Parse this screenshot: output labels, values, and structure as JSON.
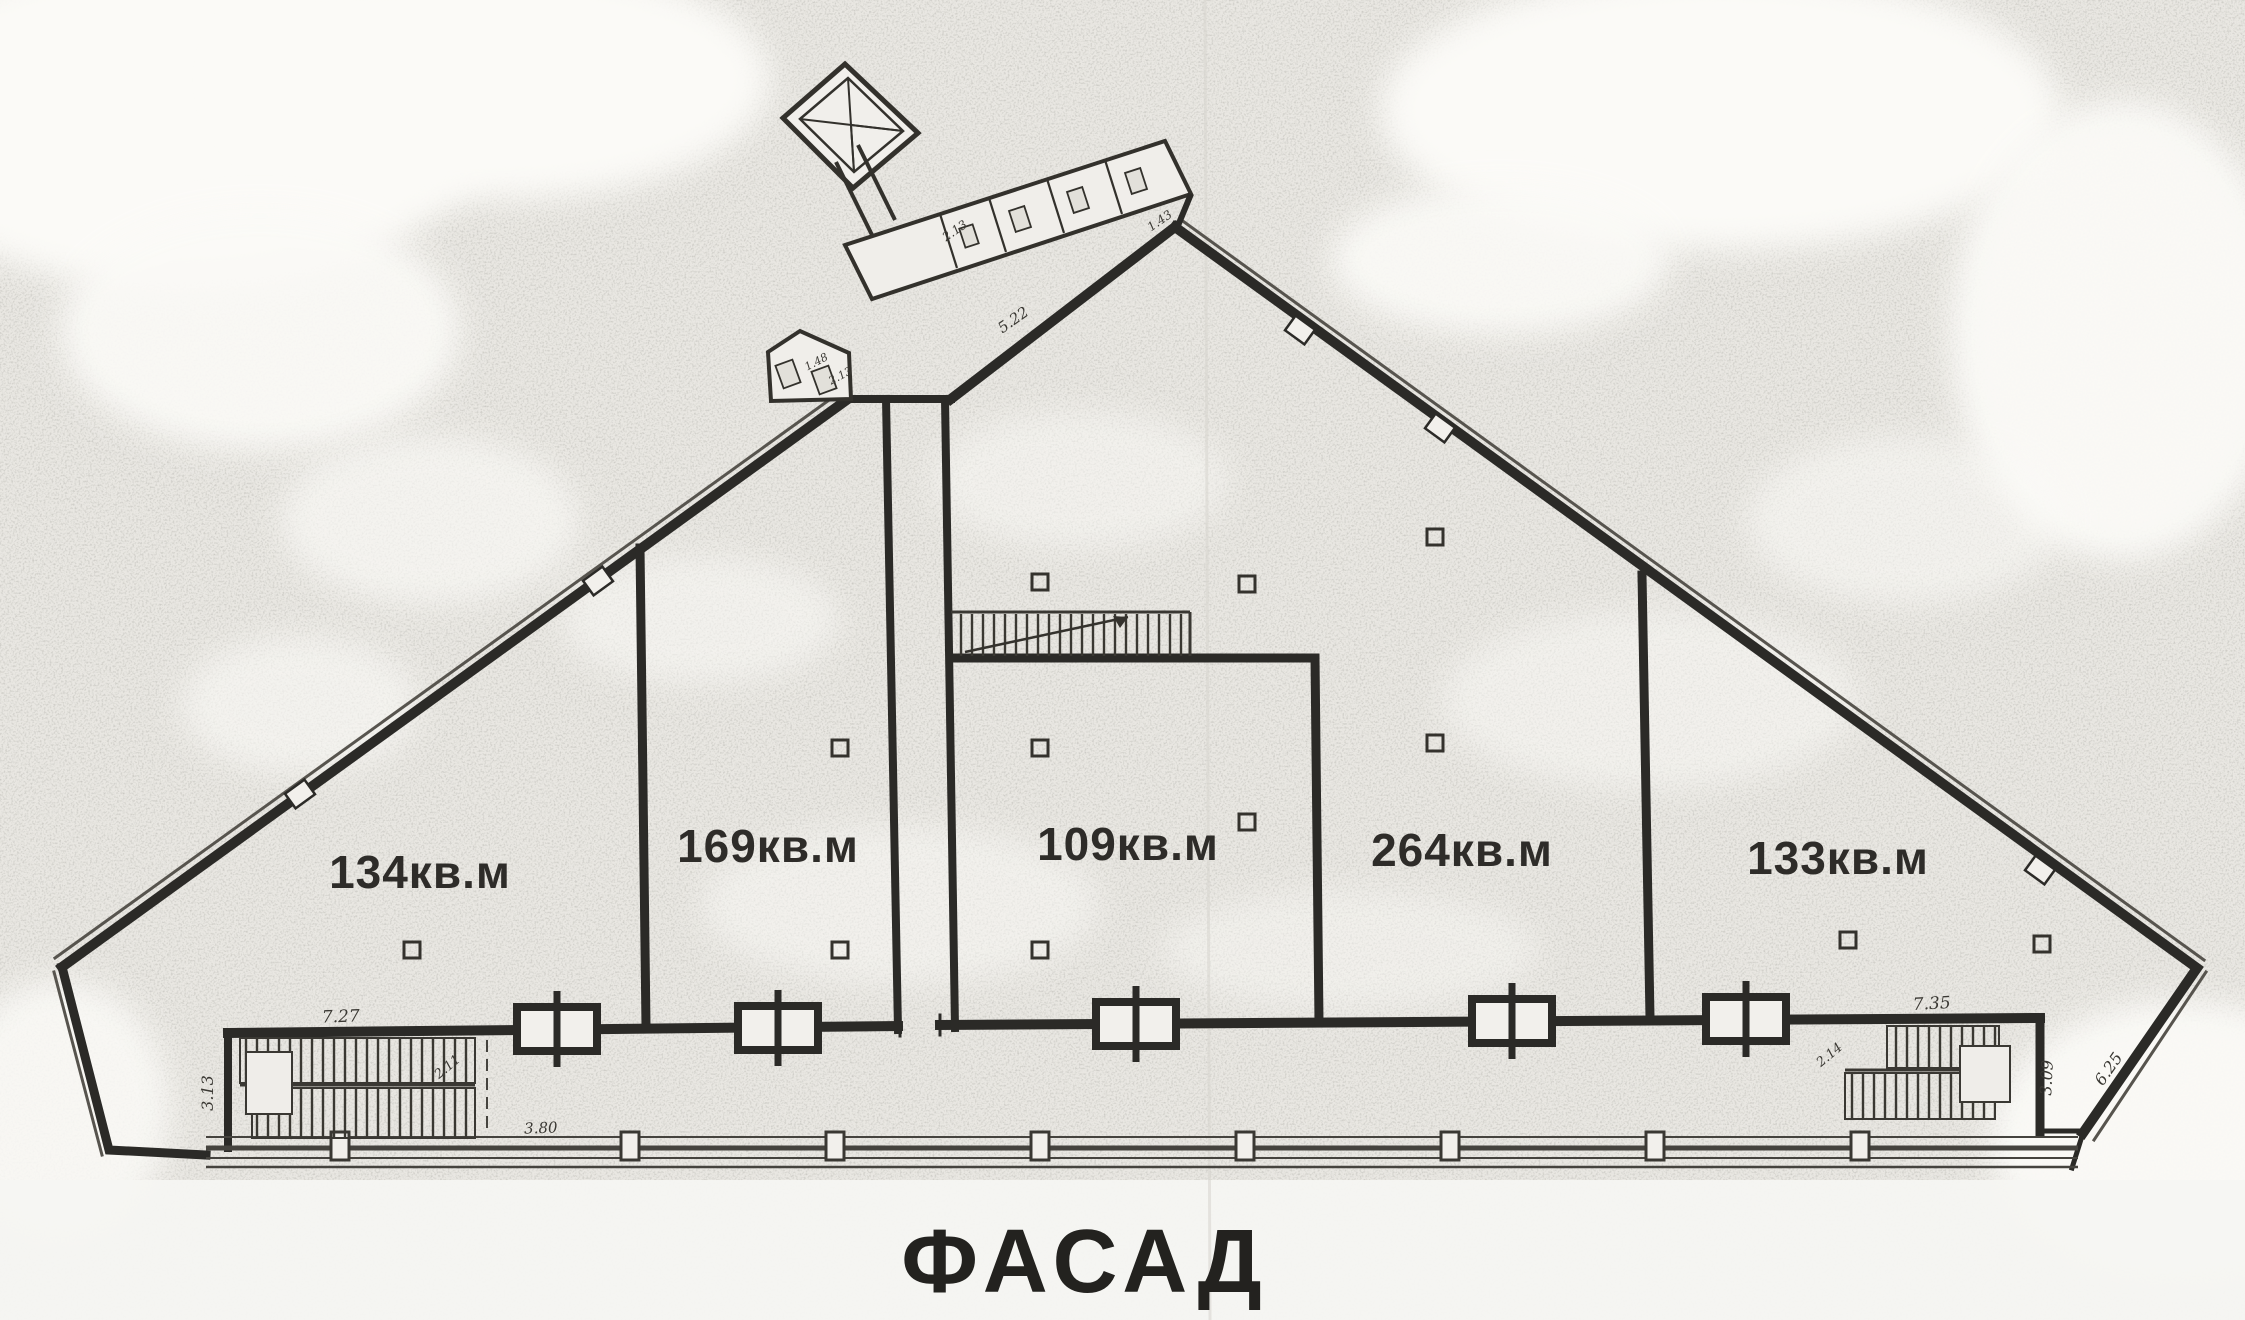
{
  "caption": "ФАСАД",
  "rooms": [
    {
      "area_label": "134кв.м"
    },
    {
      "area_label": "169кв.м"
    },
    {
      "area_label": "109кв.м"
    },
    {
      "area_label": "264кв.м"
    },
    {
      "area_label": "133кв.м"
    }
  ],
  "dimensions": {
    "left_stairs_width": "7.27",
    "left_wall": "3.13",
    "bottom_left": "3.80",
    "left_stairs_run": "2.11",
    "upper_wall": "5.22",
    "right_stairs_width": "7.35",
    "right_stairs_depth": "3.09",
    "right_edge": "6.25",
    "right_stairs_run": "2.14",
    "annex": [
      "1.48",
      "2.13",
      "1.43",
      "2.13"
    ]
  },
  "colors": {
    "wall": "#2b2a27",
    "paper": "#e9e7e2",
    "ink_text": "#2e2c29"
  }
}
